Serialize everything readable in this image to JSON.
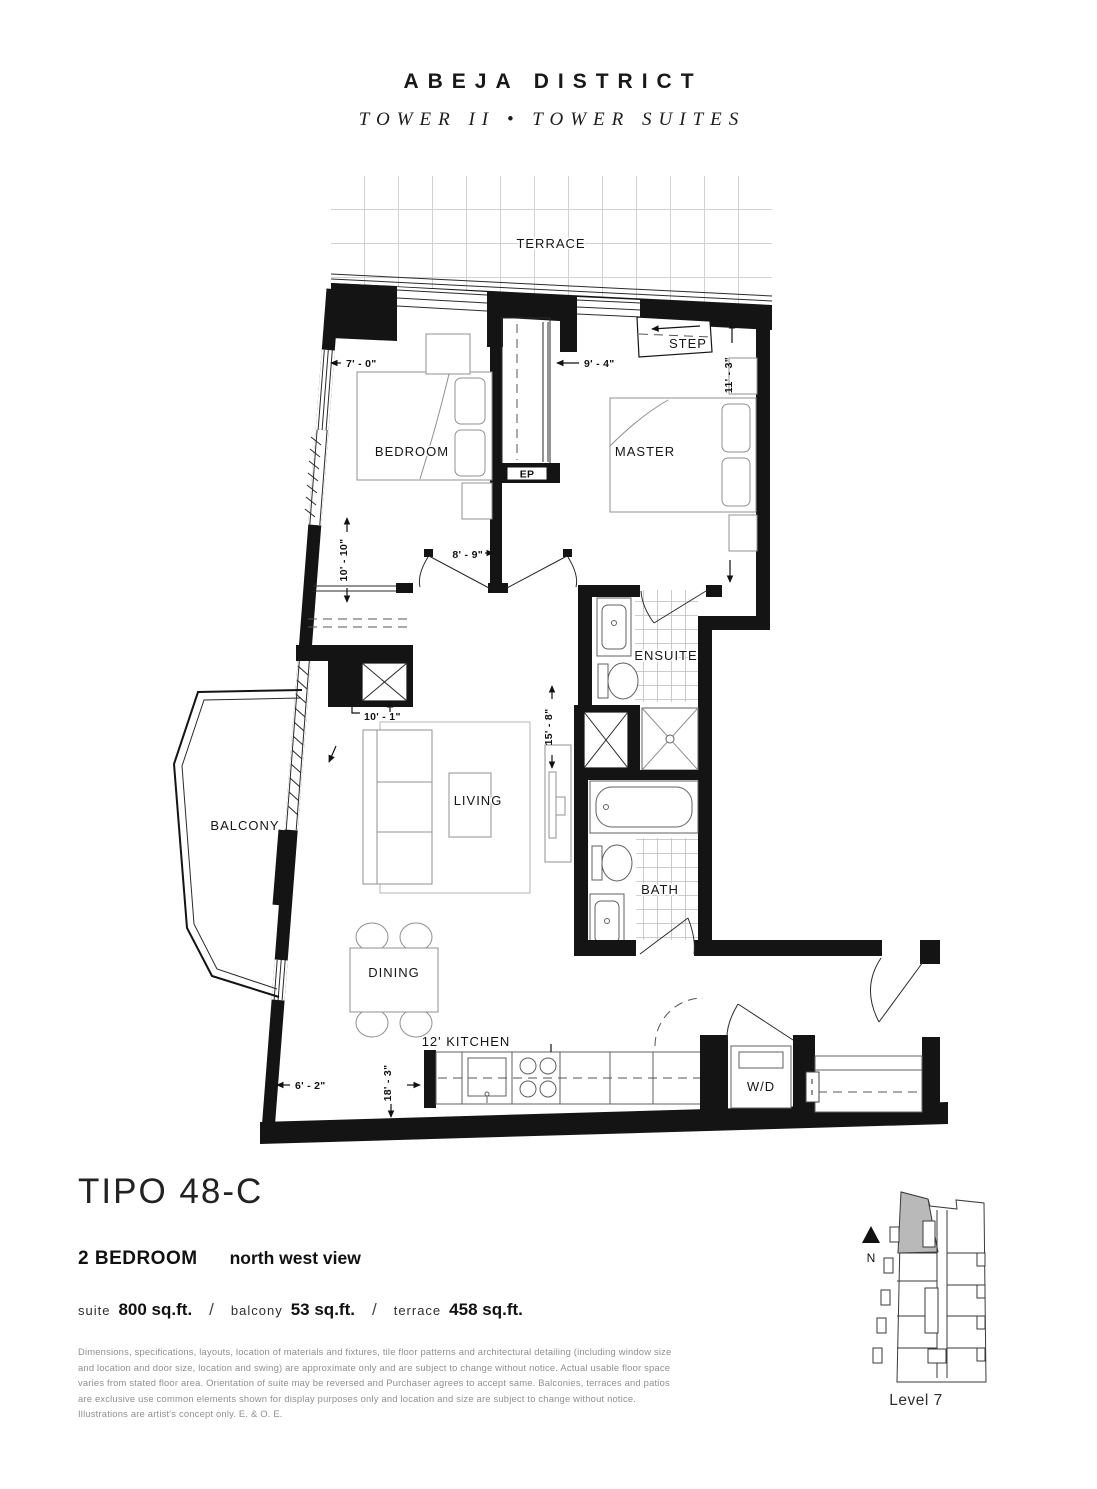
{
  "header": {
    "brand": "ABEJA DISTRICT",
    "subbrand": "TOWER II  •  TOWER SUITES"
  },
  "plan": {
    "labels": {
      "terrace": "TERRACE",
      "step": "STEP",
      "bedroom": "BEDROOM",
      "master": "MASTER",
      "ensuite": "ENSUITE",
      "bath": "BATH",
      "living": "LIVING",
      "dining": "DINING",
      "kitchen": "12' KITCHEN",
      "washer_dryer": "W/D",
      "balcony": "BALCONY",
      "electrical_panel": "EP"
    },
    "dims": {
      "bedroom_width": "7' - 0\"",
      "closet_width": "9' - 4\"",
      "master_depth": "11' - 3\"",
      "bedroom_depth": "10' - 10\"",
      "bedroom_doors": "8' - 9\"",
      "living_width": "10' - 1\"",
      "living_depth": "15' - 8\"",
      "balcony_width": "6' - 2\"",
      "kitchen_run": "18' - 3\""
    }
  },
  "titleblock": {
    "plan_name": "TIPO 48-C",
    "bedrooms": "2 BEDROOM",
    "view": "north west view",
    "slash": "/",
    "suite_label": "suite",
    "suite_area": "800 sq.ft.",
    "balcony_label": "balcony",
    "balcony_area": "53 sq.ft.",
    "terrace_label": "terrace",
    "terrace_area": "458 sq.ft."
  },
  "disclaimer": "Dimensions, specifications, layouts, location of materials and fixtures, tile floor patterns and architectural detailing (including window size and location and door size, location and swing) are approximate only and are subject to change without notice. Actual usable floor space varies from stated floor area. Orientation of suite may be reversed and Purchaser agrees to accept same. Balconies, terraces and patios are exclusive use common elements shown for display purposes only and location and size are subject to change without notice. Illustrations are artist's concept only. E. & O. E.",
  "keyplan": {
    "level": "Level 7",
    "north": "N"
  }
}
